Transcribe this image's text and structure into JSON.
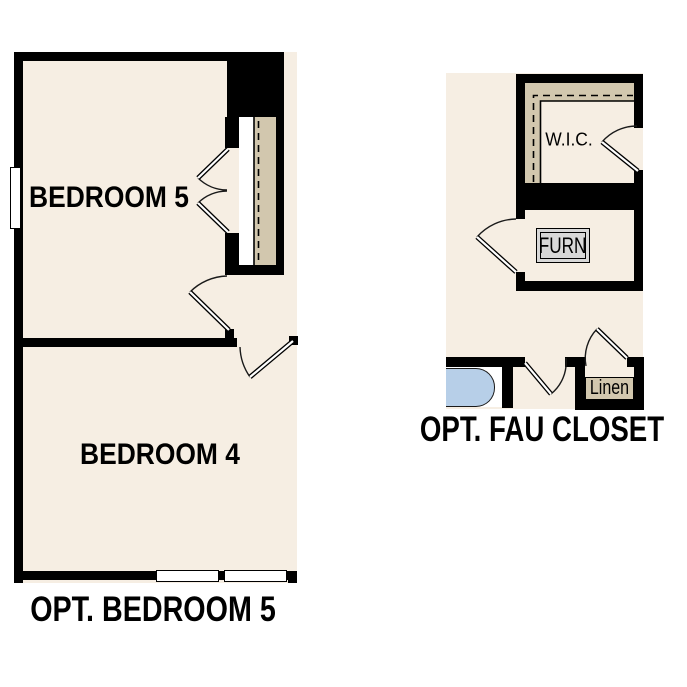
{
  "plans": {
    "opt_bedroom5": {
      "caption": "OPT. BEDROOM 5",
      "rooms": {
        "bedroom5": "BEDROOM 5",
        "bedroom4": "BEDROOM 4"
      }
    },
    "opt_fau_closet": {
      "caption": "OPT. FAU CLOSET",
      "rooms": {
        "wic": "W.I.C.",
        "furnace": "FURN",
        "linen": "Linen"
      }
    }
  },
  "colors": {
    "floor_cream": "#f6eee3",
    "shelf_tan": "#d2c7ae",
    "tub_blue": "#b7cfe8",
    "furnace_gray": "#d8d8d8",
    "wall_black": "#000000",
    "page_white": "#ffffff"
  }
}
